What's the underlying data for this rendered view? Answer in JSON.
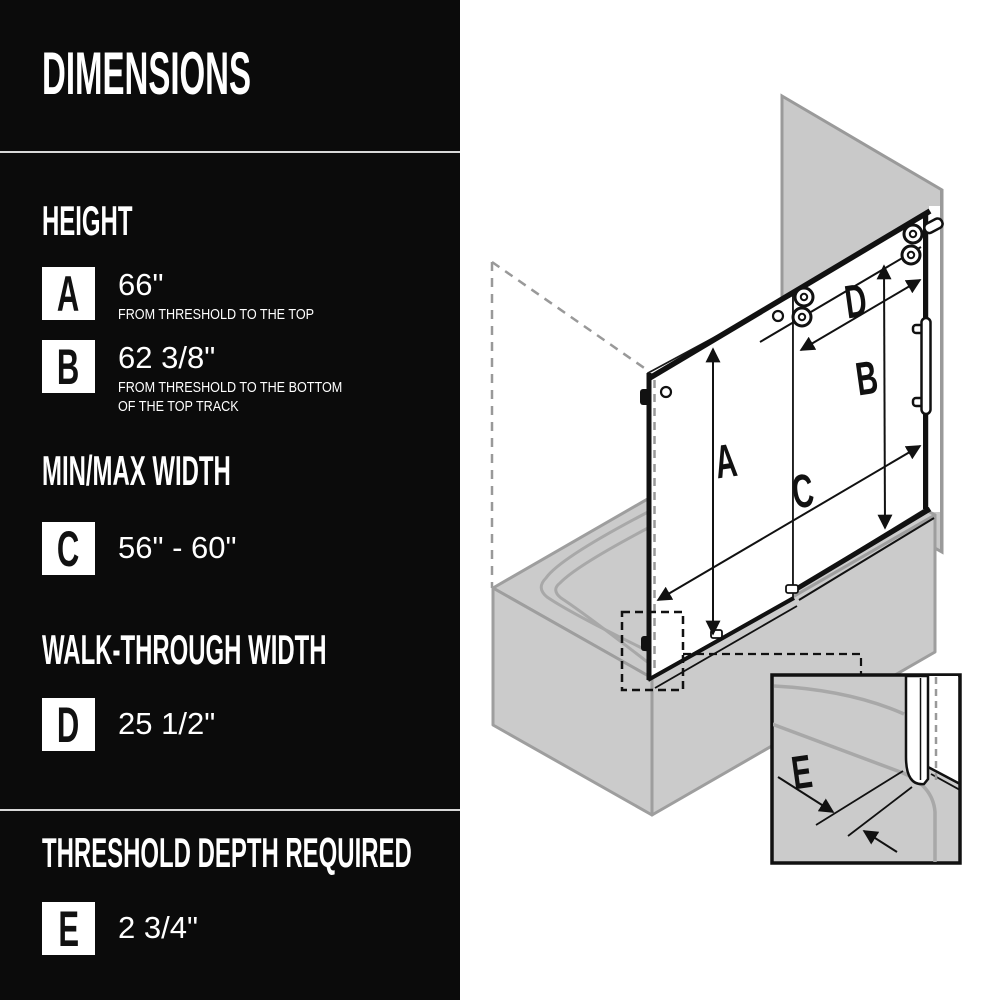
{
  "panel": {
    "title": "DIMENSIONS",
    "sections": [
      {
        "heading": "HEIGHT",
        "rows": [
          {
            "letter": "A",
            "value": "66\"",
            "desc1": "FROM THRESHOLD TO THE TOP",
            "desc2": ""
          },
          {
            "letter": "B",
            "value": "62 3/8\"",
            "desc1": "FROM THRESHOLD TO THE BOTTOM",
            "desc2": "OF THE TOP TRACK"
          }
        ]
      },
      {
        "heading": "MIN/MAX WIDTH",
        "rows": [
          {
            "letter": "C",
            "value": "56\" - 60\"",
            "desc1": "",
            "desc2": ""
          }
        ]
      },
      {
        "heading": "WALK-THROUGH WIDTH",
        "rows": [
          {
            "letter": "D",
            "value": "25 1/2\"",
            "desc1": "",
            "desc2": ""
          }
        ]
      },
      {
        "heading": "THRESHOLD DEPTH REQUIRED",
        "rows": [
          {
            "letter": "E",
            "value": "2 3/4\"",
            "desc1": "",
            "desc2": ""
          }
        ]
      }
    ]
  },
  "diagram": {
    "labels": {
      "a": "A",
      "b": "B",
      "c": "C",
      "d": "D",
      "e": "E"
    }
  },
  "colors": {
    "panel_bg": "#0b0b0b",
    "panel_text": "#ffffff",
    "divider": "#d9d9d9",
    "badge_bg": "#ffffff",
    "badge_text": "#111111",
    "line": "#111111",
    "wall_fill": "#c9c9c9",
    "wall_edge": "#9a9a9a",
    "tub_fill": "#cbcbcb",
    "tub_edge": "#9e9e9e",
    "basin_edge": "#a8a8a8",
    "dashed_gray": "#999999"
  }
}
